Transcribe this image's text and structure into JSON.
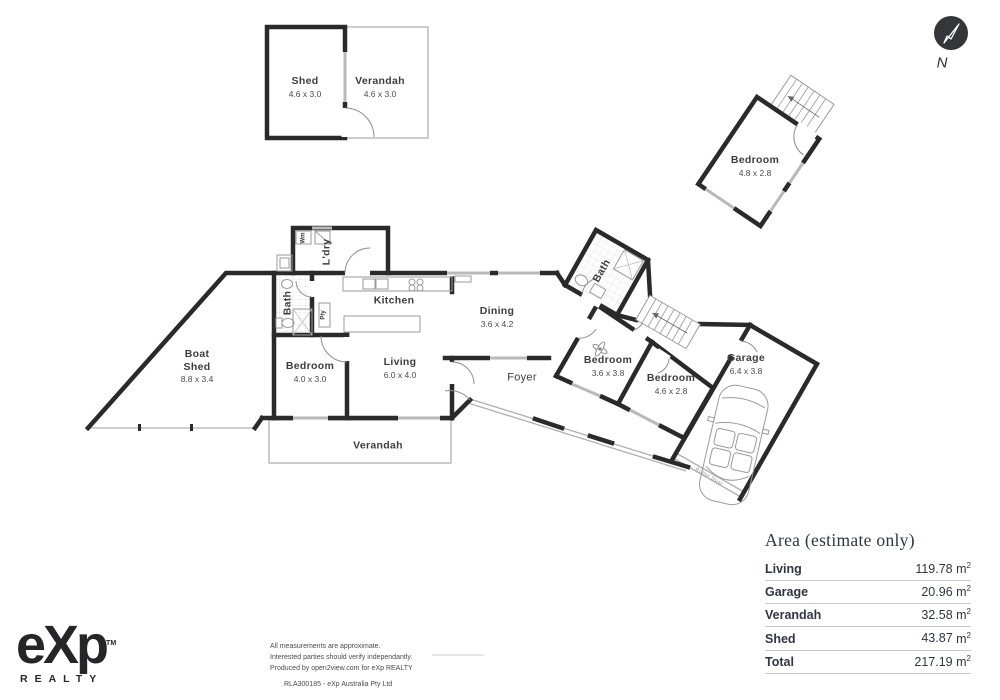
{
  "north": {
    "label": "N"
  },
  "rooms": {
    "shed_tl": {
      "name": "Shed",
      "dims": "4.6 x 3.0"
    },
    "verandah_tl": {
      "name": "Verandah",
      "dims": "4.6 x 3.0"
    },
    "bedroom_tr": {
      "name": "Bedroom",
      "dims": "4.8 x 2.8"
    },
    "boat_shed": {
      "line1": "Boat",
      "line2": "Shed",
      "dims": "8.8 x 3.4"
    },
    "bath_left": {
      "name": "Bath"
    },
    "laundry": {
      "name": "L'dry"
    },
    "washing_machine": {
      "abbr": "Wm"
    },
    "pantry": {
      "abbr": "Pty"
    },
    "kitchen": {
      "name": "Kitchen"
    },
    "dining": {
      "name": "Dining",
      "dims": "3.6 x 4.2"
    },
    "bedroom_left": {
      "name": "Bedroom",
      "dims": "4.0 x 3.0"
    },
    "living": {
      "name": "Living",
      "dims": "6.0 x 4.0"
    },
    "foyer": {
      "name": "Foyer"
    },
    "verandah_main": {
      "name": "Verandah"
    },
    "bath_right": {
      "name": "Bath"
    },
    "bedroom_mid": {
      "name": "Bedroom",
      "dims": "3.6 x 3.8"
    },
    "bedroom_right": {
      "name": "Bedroom",
      "dims": "4.6 x 2.8"
    },
    "garage": {
      "name": "Garage",
      "dims": "6.4 x 3.8"
    },
    "roller_door": {
      "label": "Roller Door"
    }
  },
  "area_table": {
    "title": "Area (estimate only)",
    "unit_base": "m",
    "unit_sup": "2",
    "rows": [
      {
        "label": "Living",
        "value": "119.78"
      },
      {
        "label": "Garage",
        "value": "20.96"
      },
      {
        "label": "Verandah",
        "value": "32.58"
      },
      {
        "label": "Shed",
        "value": "43.87"
      },
      {
        "label": "Total",
        "value": "217.19"
      }
    ]
  },
  "footer": {
    "logo_text": "eXp",
    "logo_tm": "TM",
    "logo_sub": "REALTY",
    "disclaimer_lines": [
      "All measurements are approximate.",
      "Interested parties should verify independantly.",
      "Produced by open2view.com for eXp REALTY"
    ],
    "rla": "RLA300185 - eXp Australia Pty Ltd"
  },
  "colors": {
    "wall": "#2a2a2a",
    "window": "#b9b9b9",
    "label_text": "#3d3d3d",
    "table_text": "#2f3542"
  }
}
